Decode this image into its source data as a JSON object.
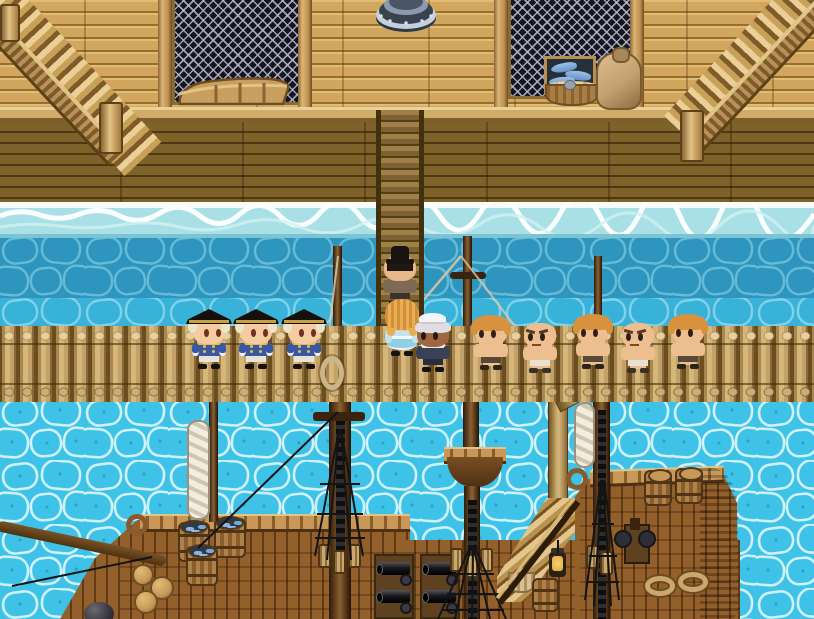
{
  "scene": {
    "type": "game-screenshot",
    "style": "16-bit RPG pixel-art",
    "setting": "Harbor boardwalk above the water with a log pier and a moored wooden sailing ship",
    "viewport": {
      "width": 814,
      "height": 619
    }
  },
  "palette": {
    "wall_wood": "#D2A65E",
    "deck_dark_wood": "#7E6229",
    "ledge": "#CFAC6A",
    "pier_log": "#C2A268",
    "gangplank": "#7E6234",
    "water_teal": "#2E96BE",
    "water_mid": "#38B2D8",
    "water_bright": "#3EC2E8",
    "foam": "#F4FBF9",
    "ship_wood": "#935F2B",
    "mast_wood": "#4E3014",
    "rigging": "#141414",
    "sail": "#EFEADC",
    "lattice_bg": "#16141E",
    "lattice_grid": "#B6BCD0",
    "funnel_metal": "#8C9AAE",
    "fish_blue": "#7FA8D8",
    "cannon_black": "#17171B"
  },
  "structures": {
    "upper_deck": {
      "left_staircase": "wooden staircase with railing rising to upper-left",
      "right_staircase": "wooden staircase with railing rising to upper-right",
      "left_window": "dark lattice window with rowboat stored in front",
      "right_window": "dark lattice window",
      "funnel": "riveted metal funnel/chimney at top center",
      "fish_crate": "wooden crate full of blue fish",
      "grain_basket": "round basket of grain with scoop",
      "grain_sack": "tied burlap sack",
      "gangway": "plank gangway leading down from deck to pier"
    },
    "pier": "horizontal pier of vertical logs spanning full width",
    "dock_piling": "support post in the water under the pier",
    "rope_loop": "coiled rope hanging on pier near foremast",
    "ship": {
      "bow": "curved prow deck with railing, carved curl, clay jugs and bowsprit",
      "fish_barrels": [
        "barrel of fish",
        "barrel of fish",
        "barrel of fish"
      ],
      "fore_mast": "mast with yard, rigging and pulley blocks",
      "main_mast": "tall mast with crow's nest and rigging net",
      "mizzen_mast": "stern mast with rigging and furled sail",
      "furled_sails": [
        "furled white sail near bow mast",
        "furled white sail at stern mast"
      ],
      "cannon_batteries": [
        "two black cannons on carriage",
        "two black cannons on carriage"
      ],
      "ship_staircase": "stairs up to the stern deck",
      "lantern": "hanging deck lantern",
      "supply_basket": "pale wicker basket",
      "deck_barrel": "barrel beside the stairs",
      "stern_deck": "raised stern with railing, two barrels, windlass and two rope coils",
      "cannonball": "dark round cannonball at lower-left hull"
    }
  },
  "characters": [
    {
      "id": "naval-officer-1",
      "role": "Naval officer in blue coat and gold-trimmed black tricorn hat",
      "variant": "officer",
      "facing": "right",
      "x": 186,
      "y": 309
    },
    {
      "id": "naval-officer-2",
      "role": "Naval officer in blue coat and gold-trimmed black tricorn hat",
      "variant": "officer",
      "facing": "right",
      "x": 233,
      "y": 309
    },
    {
      "id": "naval-officer-3",
      "role": "Naval officer in blue coat and gold-trimmed black tricorn hat",
      "variant": "officer",
      "facing": "right",
      "x": 281,
      "y": 309
    },
    {
      "id": "top-hat-gentleman",
      "role": "Man in black top hat and brown coat walking down the gangway, seen from behind",
      "variant": "tophat",
      "facing": "away",
      "x": 377,
      "y": 246
    },
    {
      "id": "blonde-woman",
      "role": "Blonde woman in light blue skirt at the foot of the gangway, seen from behind",
      "variant": "blonde-dress",
      "facing": "away",
      "x": 379,
      "y": 296
    },
    {
      "id": "white-capped-sailor",
      "role": "Dark-skinned sailor with white hair and cap in navy uniform",
      "variant": "dark-sailor",
      "facing": "left",
      "x": 410,
      "y": 312
    },
    {
      "id": "shirtless-sailor-1",
      "role": "Shirtless deckhand with shaggy blonde hair",
      "variant": "blonde-shirtless",
      "facing": "left",
      "x": 468,
      "y": 310
    },
    {
      "id": "bald-deckhand-1",
      "role": "Bald muscular shirtless deckhand in white shorts",
      "variant": "bald-shirtless",
      "facing": "left",
      "x": 517,
      "y": 313
    },
    {
      "id": "shirtless-sailor-2",
      "role": "Shirtless deckhand with shaggy blonde hair",
      "variant": "blonde-shirtless",
      "facing": "left",
      "x": 570,
      "y": 309
    },
    {
      "id": "bald-deckhand-2",
      "role": "Bald muscular shirtless deckhand in white shorts",
      "variant": "bald-shirtless",
      "facing": "left",
      "x": 615,
      "y": 313
    },
    {
      "id": "shirtless-sailor-3",
      "role": "Shirtless deckhand with shaggy blonde hair",
      "variant": "blonde-shirtless",
      "facing": "left",
      "x": 665,
      "y": 309
    }
  ],
  "sprite_variants": {
    "officer": {
      "hat": "tricorn",
      "hair": "#ECE4C6",
      "skin": "#F4CBA2",
      "eyecolor": "#703020",
      "body": "#3A58A2",
      "trim": "#E8C050",
      "pants": "#E8E4D8",
      "shoes": "#16120E",
      "eyes": "right"
    },
    "tophat": {
      "hat": "tophat",
      "hair": "#1E1914",
      "skin": "#E8B88C",
      "body": "#7E6A52",
      "pants": "#3A3430",
      "shoes": "#141010",
      "back": true
    },
    "blonde-dress": {
      "hair": "#EBAD52",
      "skin": "#F2C69C",
      "body": "#C2E4EE",
      "skirt": "#8FD0E2",
      "back": true,
      "longhair": true
    },
    "dark-sailor": {
      "cap": "#F4F4F6",
      "hair": "#DEDEE4",
      "skin": "#A06640",
      "eyecolor": "#241A14",
      "body": "#3A4056",
      "trim": "#ECECF0",
      "pants": "#282C3E",
      "shoes": "#14110E",
      "eyes": "left"
    },
    "blonde-shirtless": {
      "hair": "#D8913C",
      "skin": "#ECBE90",
      "eyecolor": "#2E2018",
      "shorts": "#584838",
      "shoes": "#2C231B",
      "eyes": "left",
      "shirtless": true
    },
    "bald-shirtless": {
      "skin": "#ECBE90",
      "eyecolor": "#2E2018",
      "shorts": "#E6E2D4",
      "shoes": "#3A3028",
      "eyes": "left",
      "angry": true,
      "shirtless": true
    }
  }
}
